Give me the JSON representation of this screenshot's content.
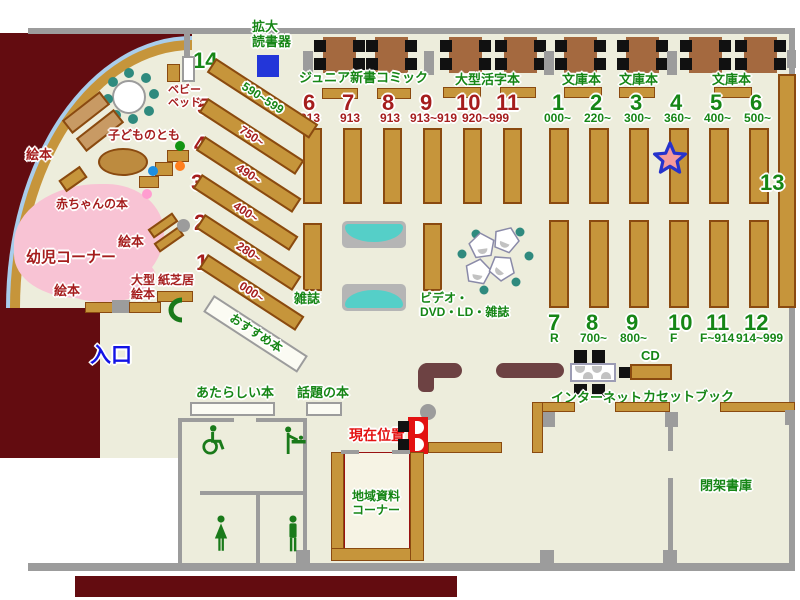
{
  "colors": {
    "floor": "#EDEDDC",
    "outside": "#630C10",
    "shelf": "#C6953B",
    "wall": "#9C9C9C",
    "green_label": "#168616",
    "red_label": "#A51D1D",
    "bright_red": "#E31212",
    "entrance_blue": "#1414E6",
    "counter": "#6D4243",
    "sofa_cyan": "#55CFC8",
    "kids_pink": "#F8C3D4",
    "table_brown": "#A4693F"
  },
  "top": {
    "magnifier": "拡大\n読書器",
    "junior": "ジュニア新書",
    "comic": "コミック",
    "large_print": "大型活字本",
    "bunko1": "文庫本",
    "bunko2": "文庫本",
    "bunko3": "文庫本"
  },
  "red_bank": {
    "items": [
      {
        "no": "6",
        "range": "913"
      },
      {
        "no": "7",
        "range": "913"
      },
      {
        "no": "8",
        "range": "913"
      },
      {
        "no": "9",
        "range": "913~919"
      },
      {
        "no": "10",
        "range": ""
      },
      {
        "no": "11",
        "range": ""
      }
    ],
    "shared_range": "920~999"
  },
  "green_top": {
    "items": [
      {
        "no": "1",
        "range": "000~"
      },
      {
        "no": "2",
        "range": "220~"
      },
      {
        "no": "3",
        "range": "300~"
      },
      {
        "no": "4",
        "range": "360~"
      },
      {
        "no": "5",
        "range": "400~"
      },
      {
        "no": "6",
        "range": "500~"
      }
    ]
  },
  "green_bottom": {
    "items": [
      {
        "no": "7",
        "range": "R"
      },
      {
        "no": "8",
        "range": "700~"
      },
      {
        "no": "9",
        "range": "800~"
      },
      {
        "no": "10",
        "range": "F"
      },
      {
        "no": "11",
        "range": "F~914"
      },
      {
        "no": "12",
        "range": "914~999"
      }
    ]
  },
  "diagonal": {
    "items": [
      {
        "no": "14",
        "range": "590~599"
      },
      {
        "no": "5",
        "range": "750~"
      },
      {
        "no": "4",
        "range": "490~"
      },
      {
        "no": "3",
        "range": "400~"
      },
      {
        "no": "2",
        "range": "280~"
      },
      {
        "no": "1",
        "range": "000~"
      }
    ]
  },
  "shelf13": "13",
  "kids": {
    "ehon_left": "絵本",
    "kodomo": "子どものとも",
    "baby_books": "赤ちゃんの本",
    "ehon_mid": "絵本",
    "corner": "幼児コーナー",
    "ehon_bottom": "絵本",
    "baby_bed": "ベビー\nベッド",
    "large_ehon": "大型\n絵本",
    "kamishibai": "紙芝居"
  },
  "center": {
    "magazines": "雑誌",
    "video": "ビデオ・\nDVD・LD・雑誌",
    "recommended": "おすすめ本"
  },
  "entrance": "入口",
  "lower": {
    "new_books": "あたらしい本",
    "topical": "話題の本",
    "current": "現在位置",
    "cd": "CD",
    "internet": "インターネット",
    "cassette": "カセットブック",
    "local": "地域資料\nコーナー",
    "closed_stacks": "閉架書庫"
  },
  "icons": {
    "star_marker": "star",
    "wheelchair": "wheelchair",
    "baby_care": "baby-care",
    "woman": "woman",
    "man": "man",
    "door": "door-arc"
  }
}
